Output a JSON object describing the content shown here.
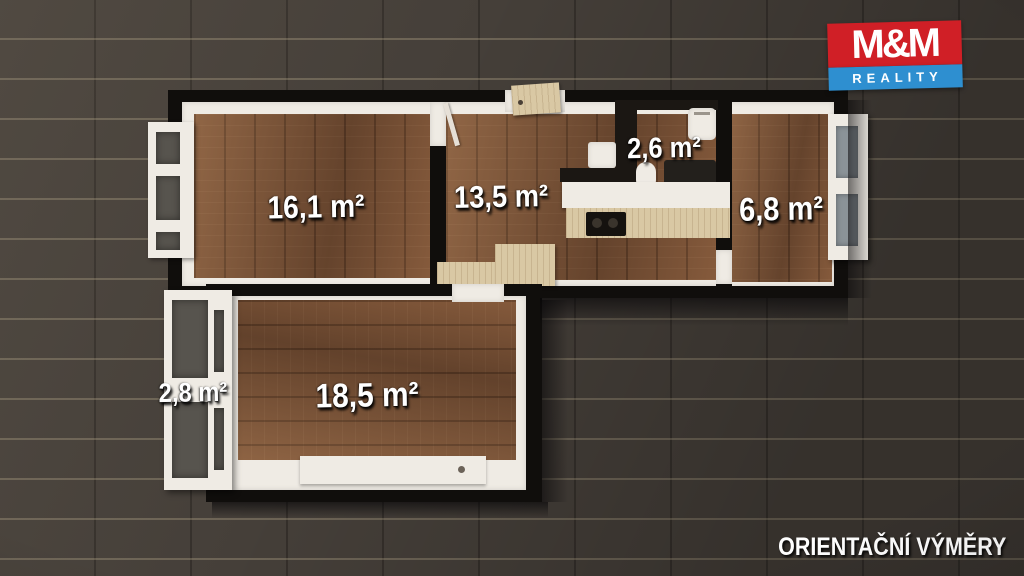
{
  "logo": {
    "top": "M&M",
    "bottom": "REALITY"
  },
  "footer_note": "ORIENTAČNÍ VÝMĚRY",
  "rooms": {
    "living": {
      "area": "16,1 m²"
    },
    "kitchen": {
      "area": "13,5 m²"
    },
    "bathroom": {
      "area": "2,6 m²"
    },
    "small_room": {
      "area": "6,8 m²"
    },
    "balcony": {
      "area": "2,8 m²"
    },
    "bedroom": {
      "area": "18,5 m²"
    }
  },
  "colors": {
    "tile_bg": "#453f39",
    "floor_wood": "#7b5236",
    "wall_black": "#100e0c",
    "trim_white": "#efebe4",
    "brand_red": "#d01f26",
    "brand_blue": "#2e8fd0"
  }
}
